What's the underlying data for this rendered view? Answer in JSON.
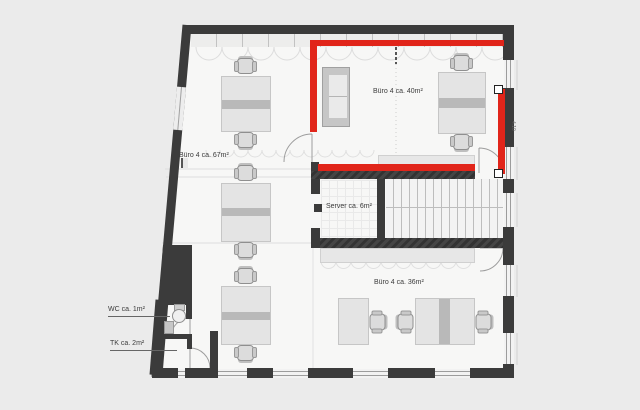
{
  "document": {
    "type": "architectural-floor-plan",
    "floor_use": "office"
  },
  "rooms": {
    "buero67": {
      "label": "Büro 4 ca. 67m²",
      "area": "67m²"
    },
    "buero40": {
      "label": "Büro 4 ca. 40m²",
      "area": "40m²"
    },
    "server": {
      "label": "Server ca. 6m²",
      "area": "6m²"
    },
    "buero36": {
      "label": "Büro 4 ca. 36m²",
      "area": "36m²"
    },
    "wc": {
      "label": "WC ca. 1m²",
      "area": "1m²"
    },
    "tk": {
      "label": "TK ca. 2m²",
      "area": "2m²"
    }
  },
  "annotation": {
    "type": "room-outline-highlight",
    "highlighted_room": "Büro 4 ca. 40m²",
    "color": "#e1251a",
    "handle_count": 2
  },
  "dimension_marker": {
    "text": "4.10"
  },
  "colors": {
    "wall": "#3b3b3b",
    "floor": "#f7f7f6",
    "background": "#ebebeb",
    "furniture": "#e4e4e4",
    "accent_red": "#e1251a"
  }
}
